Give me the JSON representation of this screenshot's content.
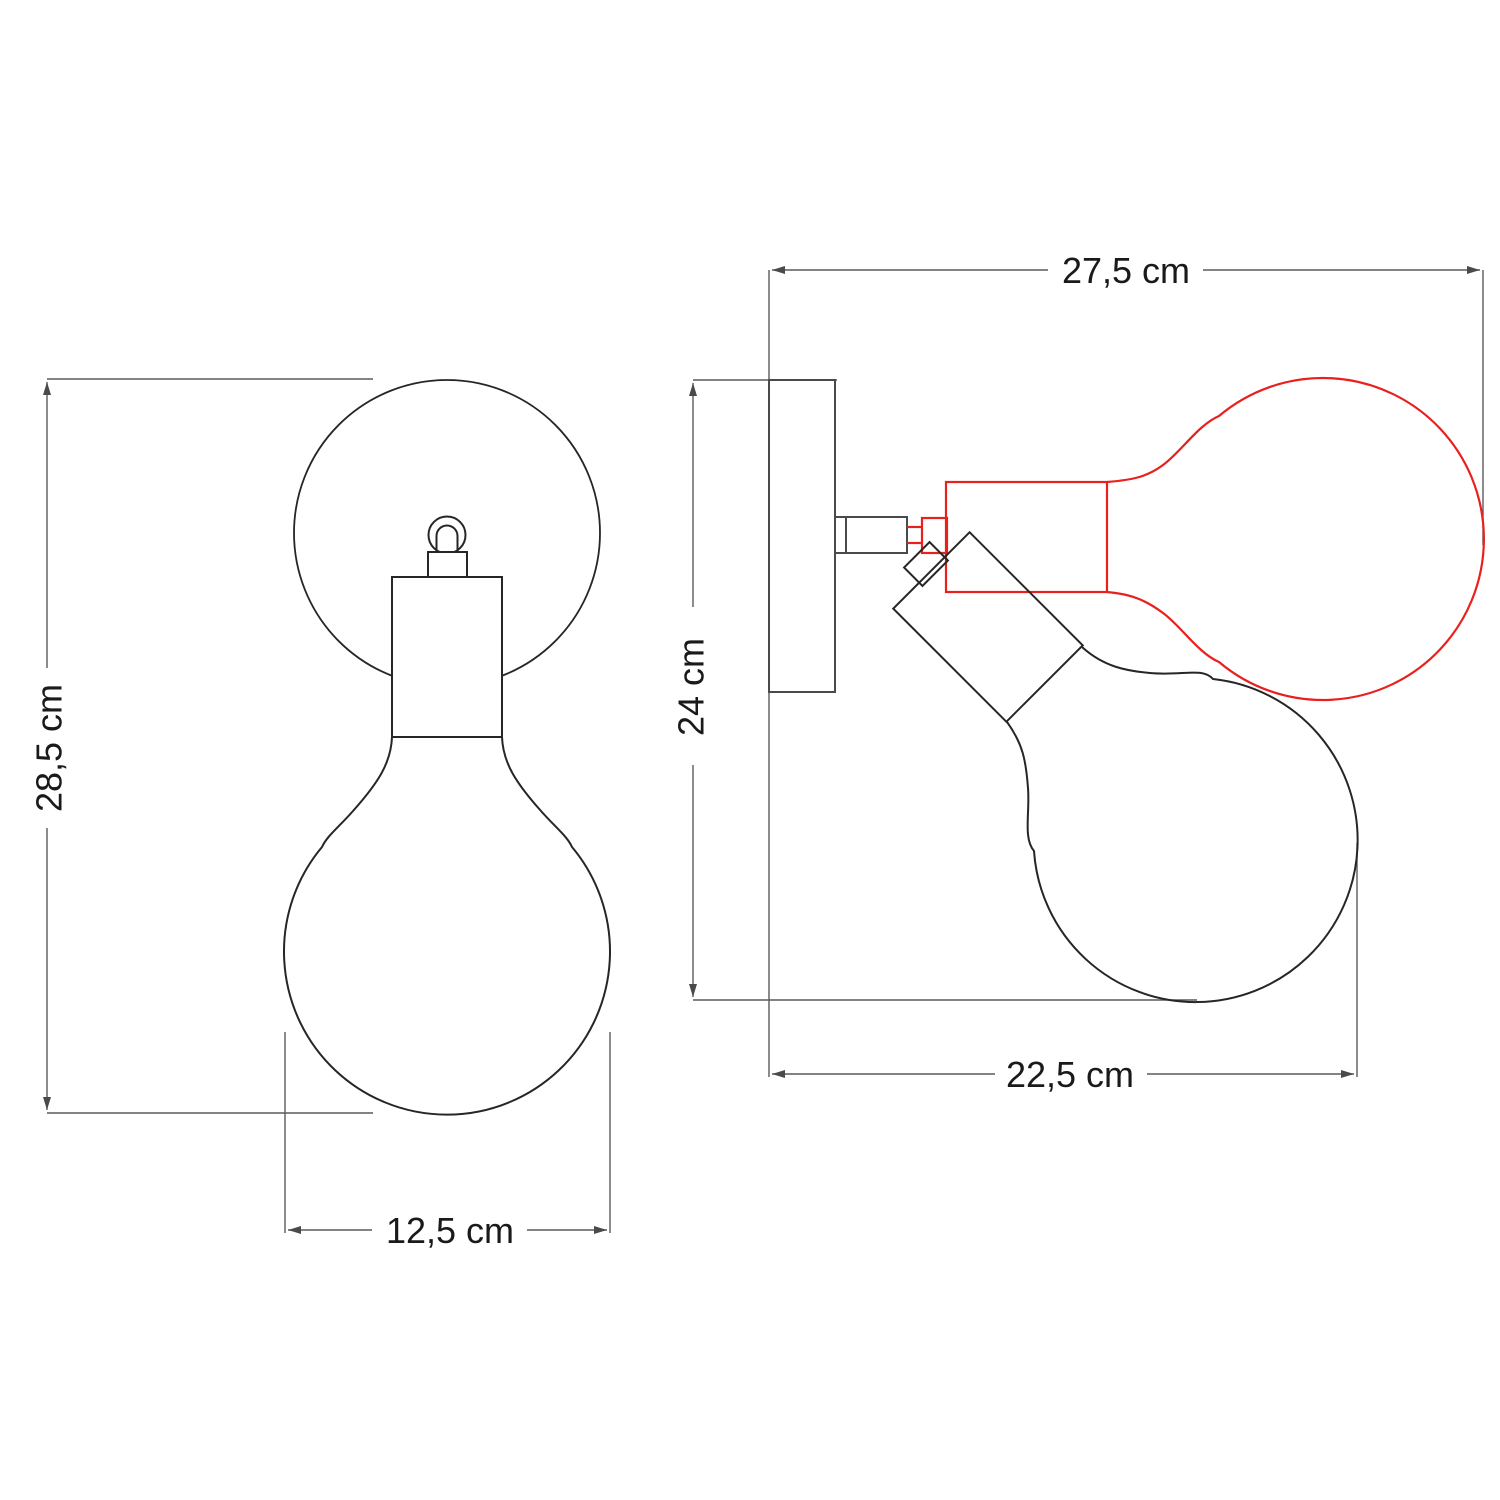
{
  "diagram": {
    "title": "wall-lamp-dimension-drawing",
    "front_view": {
      "height_label": "28,5 cm",
      "width_label": "12,5 cm"
    },
    "side_view": {
      "width_label": "27,5 cm",
      "height_label": "24 cm",
      "projection_label": "22,5 cm"
    },
    "colors": {
      "outline": "#262626",
      "hardware": "#4a4a4a",
      "dimension": "#5a5a5a",
      "alternate_position": "#e8201e",
      "label": "#1a1a1a",
      "background": "#ffffff"
    }
  }
}
